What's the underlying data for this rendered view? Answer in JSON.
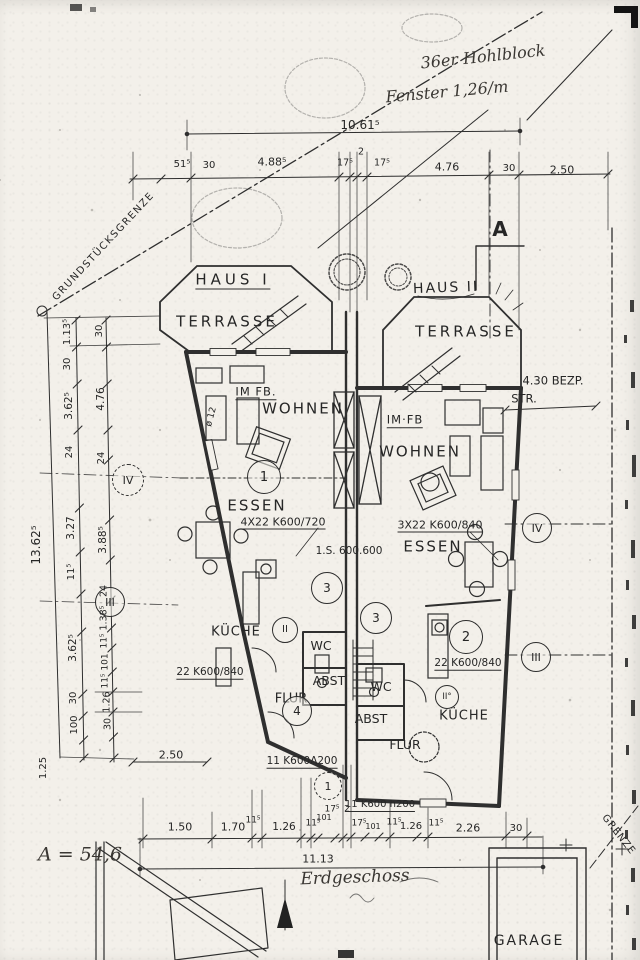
{
  "notes": {
    "block_note": "36er Hohlblock",
    "window_note": "Fenster 1,26/m",
    "area_note": "A = 54,6",
    "floor_label": "Erdgeschoss",
    "boundary_left": "GRUNDSTÜCKSGRENZE",
    "boundary_right": "GRENZE",
    "street_note": "4.30 BEZP.",
    "street_note2": "STR.",
    "section_marker": "A",
    "garage": "GARAGE"
  },
  "haus1": {
    "name": "HAUS I",
    "terrace": "TERRASSE",
    "rooms": {
      "im_fb": "IM FB.",
      "wohnen": "WOHNEN",
      "essen": "ESSEN",
      "kueche": "KÜCHE",
      "wc": "WC",
      "abst": "ABST",
      "flur": "FLUR"
    },
    "annotations": {
      "beam": "4X22 K600/720",
      "lintel": "22 K600/840",
      "door": "11 K600Λ200",
      "column": "ø 12"
    },
    "markers": {
      "m1": "1",
      "m3": "3",
      "m4": "4",
      "mII": "II"
    }
  },
  "haus2": {
    "name": "HAUS II",
    "terrace": "TERRASSE",
    "rooms": {
      "im_fb": "IM·FB",
      "wohnen": "WOHNEN",
      "essen": "ESSEN",
      "kueche": "KÜCHE",
      "wc": "WC",
      "abst": "ABST",
      "flur": "FLUR"
    },
    "annotations": {
      "beam": "3X22 K600/840",
      "lintel": "22 K600/840",
      "stair": "1.S. 600.600",
      "door": "11 K600 h200"
    },
    "markers": {
      "m2": "2",
      "m3": "3",
      "mII": "II°",
      "m1": "1"
    }
  },
  "axis_markers": {
    "left_iv": "IV",
    "left_iii": "III",
    "right_iv": "IV",
    "right_iii": "III"
  },
  "dims": {
    "top_total": "10.61⁵",
    "top_chain": [
      "51⁵",
      "30",
      "4.88⁵",
      "17⁵",
      "2",
      "17⁵",
      "4.76",
      "30",
      "2.50"
    ],
    "left_total": "13.62⁵",
    "left_col1": [
      "1.13⁵",
      "30",
      "3.62⁵",
      "24",
      "3.27",
      "11⁵",
      "3.62⁵",
      "30",
      "100",
      "1.25"
    ],
    "left_col2": [
      "30",
      "4.76",
      "24",
      "3.88⁵",
      "24",
      "1.38⁵",
      "11⁵",
      "101",
      "11⁵",
      "1.26",
      "30"
    ],
    "left_extra": "2.50",
    "bottom_chain": [
      "1.50",
      "1.70",
      "11⁵",
      "1.26",
      "11⁵",
      "101",
      "17⁵",
      "2",
      "17⁵",
      "101",
      "11⁵",
      "1.26",
      "11⁵",
      "2.26",
      "30"
    ],
    "bottom_total": "11.13"
  }
}
